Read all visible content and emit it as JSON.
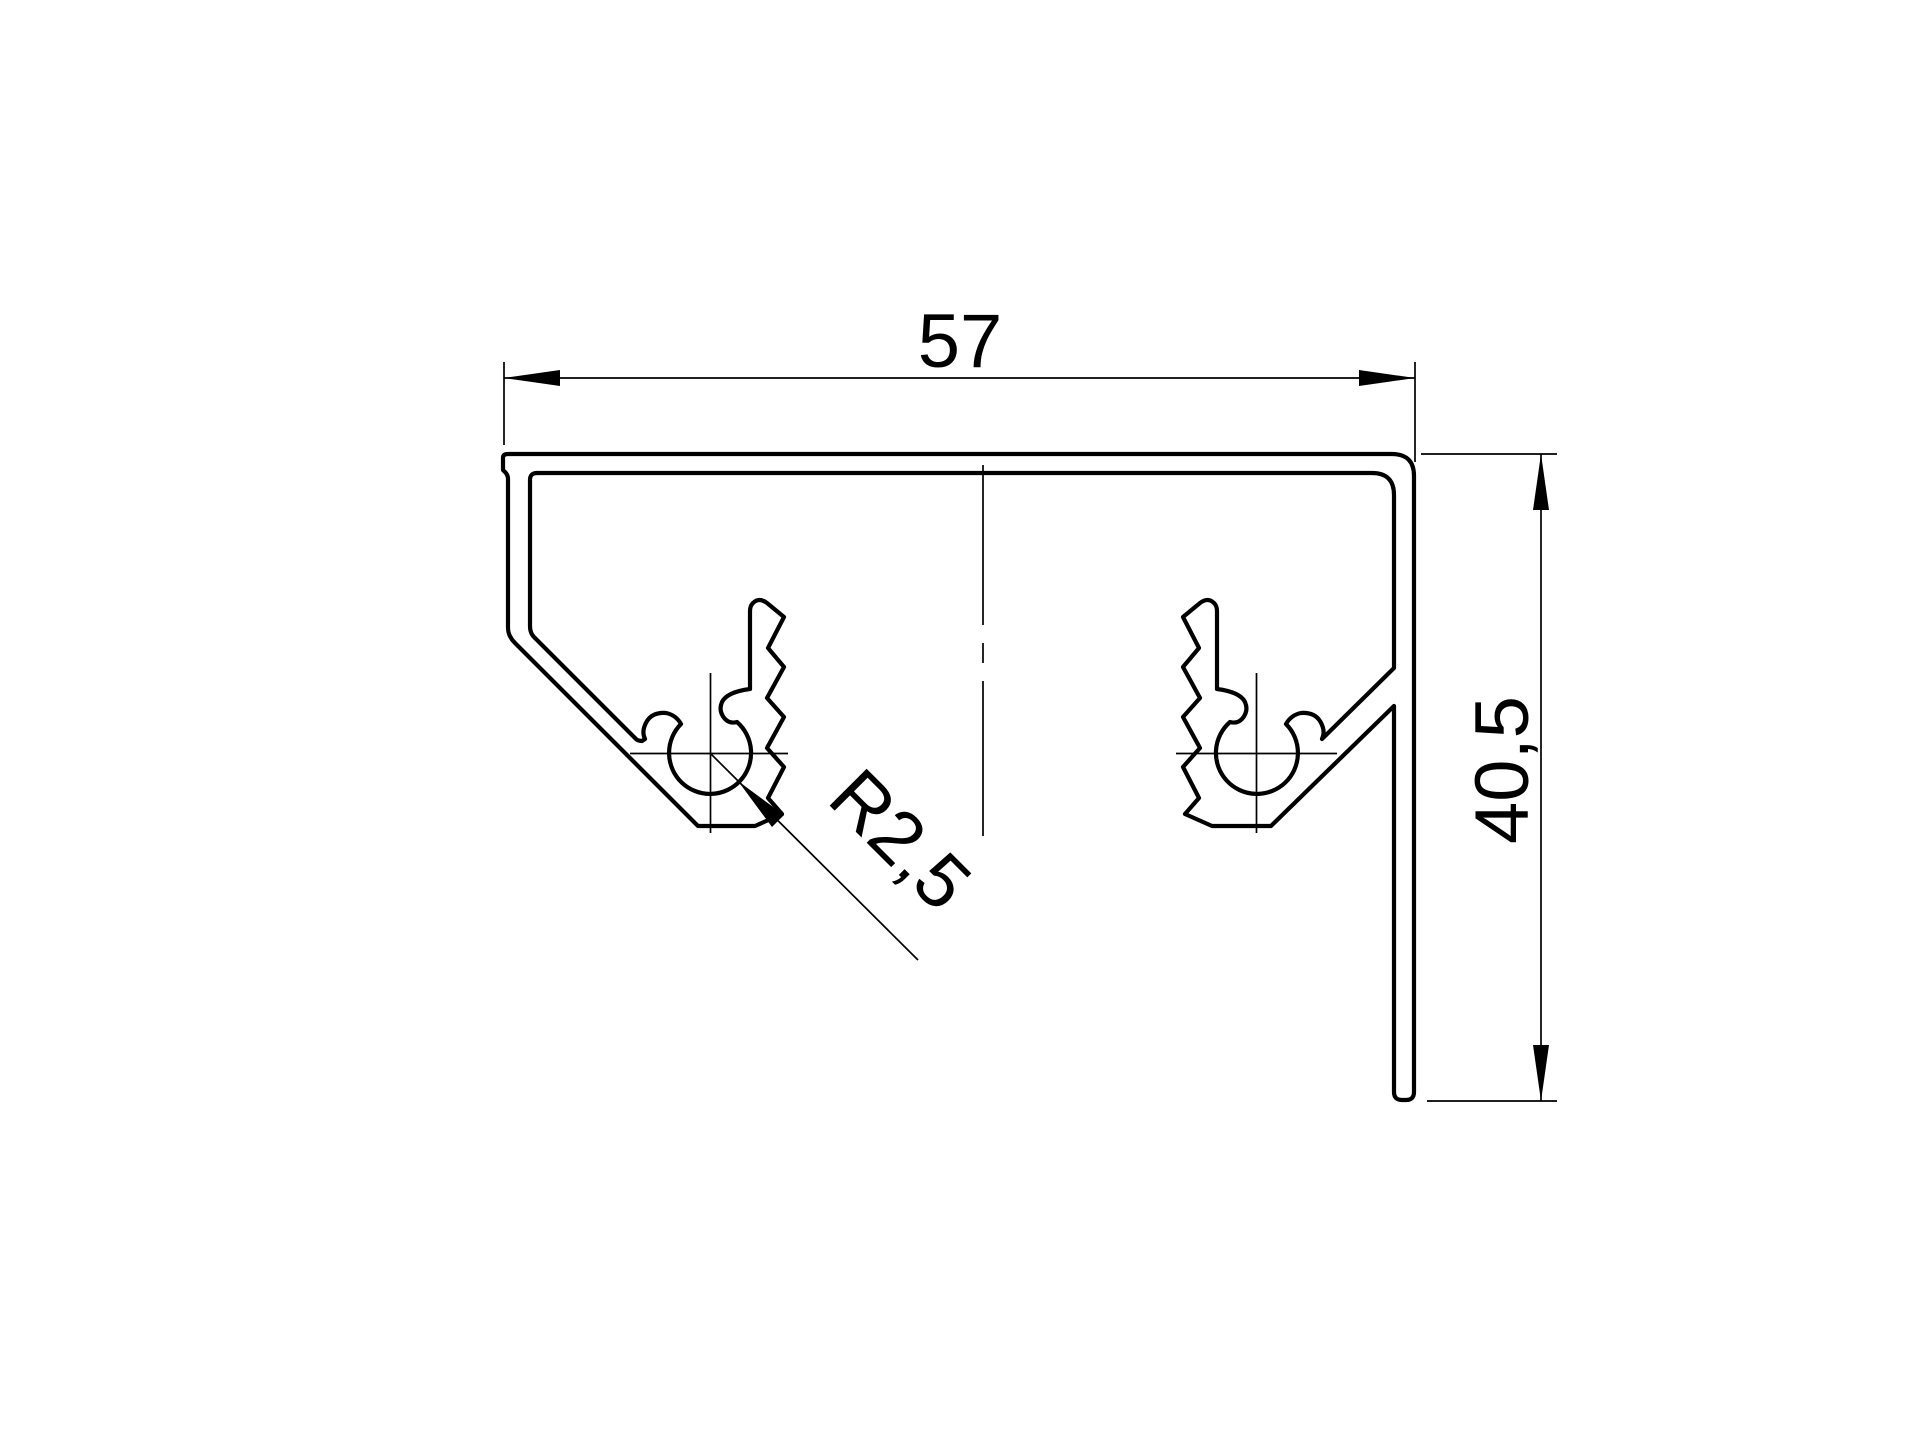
{
  "page": {
    "background_color": "#ffffff",
    "line_color": "#000000"
  },
  "drawing": {
    "kind": "profile-cross-section",
    "width_dim": {
      "label": "57",
      "orientation": "horizontal"
    },
    "height_dim": {
      "label": "40,5",
      "orientation": "vertical"
    },
    "radius_dim": {
      "label": "R2,5",
      "orientation": "diagonal-leader"
    }
  }
}
